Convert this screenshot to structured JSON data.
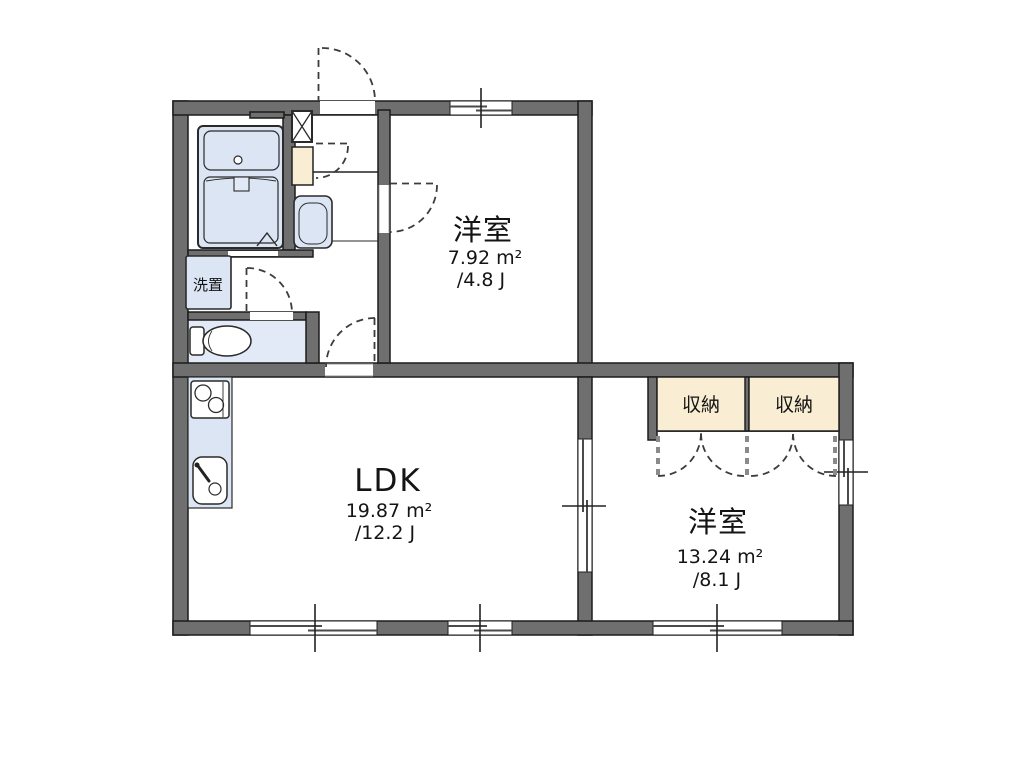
{
  "rooms": [
    {
      "id": "bedroom-top",
      "name": "洋室",
      "area_m2": "7.92 m²",
      "area_tatami": "/4.8 J"
    },
    {
      "id": "ldk",
      "name": "LDK",
      "area_m2": "19.87 m²",
      "area_tatami": "/12.2 J"
    },
    {
      "id": "bedroom-right",
      "name": "洋室",
      "area_m2": "13.24 m²",
      "area_tatami": "/8.1 J"
    }
  ],
  "storage": [
    {
      "label": "収納"
    },
    {
      "label": "収納"
    }
  ],
  "utility": {
    "laundry_label": "洗置"
  },
  "icons": [
    "bathtub-icon",
    "vanity-counter-icon",
    "wash-basin-icon",
    "pipe-shaft-icon",
    "shelf-icon",
    "toilet-icon",
    "stove-icon",
    "kitchen-sink-icon",
    "window-icon",
    "door-swing-arc-icon",
    "folding-door-arc-icon"
  ],
  "colors": {
    "wall": "#6f6f6f",
    "line": "#1c1c1c",
    "dash": "#3c3c3c",
    "fixture": "#dbe5f4",
    "fixture_light": "#e2eaf7",
    "closet": "#f9edd3",
    "background": "#ffffff"
  }
}
